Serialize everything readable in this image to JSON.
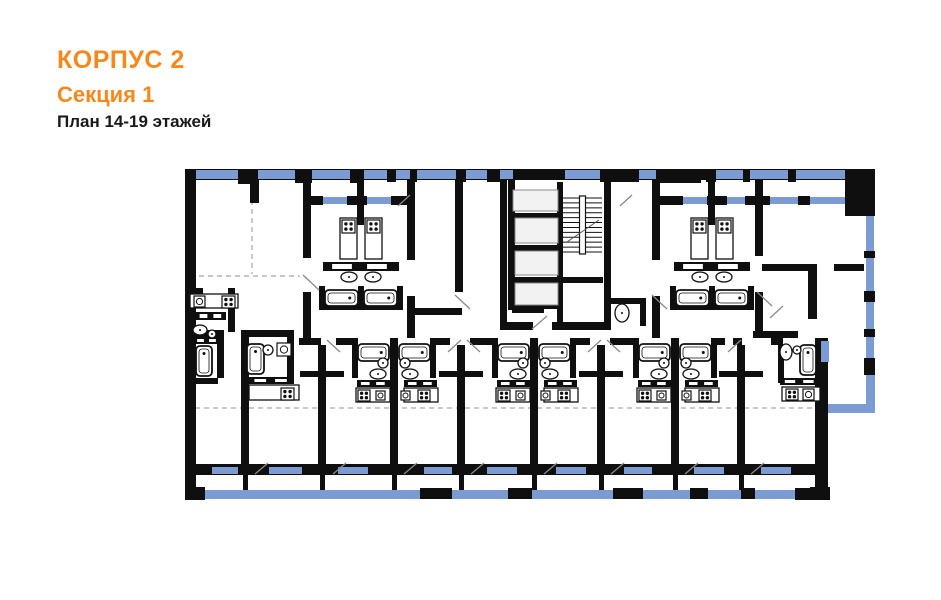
{
  "header": {
    "building": "КОРПУС 2",
    "section": "Секция 1",
    "floors": "План 14-19 этажей"
  },
  "colors": {
    "accent": "#f6891e",
    "text": "#1a1a1a",
    "wall": "#0f0f0f",
    "window": "#7b9bd2",
    "elevator_fill": "#f2f2f2",
    "elevator_stroke": "#8a8a8a",
    "fixture_stroke": "#111111",
    "door": "#8a8a8a",
    "dash": "#b5b5b5"
  },
  "plan": {
    "canvas": {
      "w": 941,
      "h": 600
    },
    "walls": [
      [
        185,
        169,
        690,
        11
      ],
      [
        185,
        169,
        11,
        331
      ],
      [
        185,
        487,
        20,
        13
      ],
      [
        238,
        169,
        20,
        15
      ],
      [
        295,
        169,
        17,
        14
      ],
      [
        350,
        169,
        14,
        14
      ],
      [
        387,
        169,
        9,
        13
      ],
      [
        410,
        169,
        7,
        13
      ],
      [
        456,
        169,
        10,
        13
      ],
      [
        487,
        169,
        13,
        13
      ],
      [
        513,
        169,
        52,
        11
      ],
      [
        600,
        169,
        39,
        13
      ],
      [
        656,
        169,
        45,
        14
      ],
      [
        706,
        169,
        10,
        13
      ],
      [
        743,
        169,
        7,
        13
      ],
      [
        788,
        169,
        8,
        13
      ],
      [
        845,
        169,
        30,
        47
      ],
      [
        864,
        169,
        11,
        47
      ],
      [
        864,
        251,
        11,
        7
      ],
      [
        864,
        291,
        11,
        11
      ],
      [
        864,
        329,
        11,
        8
      ],
      [
        864,
        358,
        11,
        17
      ],
      [
        815,
        338,
        13,
        162
      ],
      [
        810,
        487,
        20,
        13
      ],
      [
        185,
        464,
        643,
        11
      ],
      [
        310,
        196,
        13,
        9
      ],
      [
        347,
        196,
        20,
        9
      ],
      [
        391,
        196,
        20,
        9
      ],
      [
        656,
        196,
        27,
        9
      ],
      [
        707,
        196,
        20,
        9
      ],
      [
        745,
        196,
        14,
        9
      ],
      [
        760,
        196,
        10,
        9
      ],
      [
        798,
        196,
        12,
        9
      ],
      [
        845,
        196,
        14,
        9
      ],
      [
        250,
        180,
        9,
        23
      ],
      [
        303,
        180,
        8,
        78
      ],
      [
        303,
        292,
        8,
        46
      ],
      [
        357,
        180,
        7,
        45
      ],
      [
        407,
        180,
        8,
        80
      ],
      [
        407,
        296,
        8,
        42
      ],
      [
        455,
        180,
        8,
        112
      ],
      [
        500,
        180,
        7,
        150
      ],
      [
        604,
        180,
        7,
        150
      ],
      [
        652,
        180,
        8,
        80
      ],
      [
        652,
        296,
        8,
        42
      ],
      [
        708,
        180,
        7,
        45
      ],
      [
        755,
        180,
        8,
        76
      ],
      [
        755,
        292,
        8,
        46
      ],
      [
        808,
        264,
        9,
        55
      ],
      [
        407,
        308,
        55,
        7
      ],
      [
        762,
        264,
        48,
        7
      ],
      [
        834,
        264,
        30,
        7
      ],
      [
        753,
        331,
        45,
        7
      ],
      [
        319,
        286,
        6,
        24
      ],
      [
        358,
        286,
        6,
        24
      ],
      [
        397,
        286,
        6,
        24
      ],
      [
        321,
        304,
        78,
        6
      ],
      [
        670,
        286,
        6,
        24
      ],
      [
        709,
        286,
        6,
        24
      ],
      [
        748,
        286,
        6,
        24
      ],
      [
        672,
        304,
        80,
        6
      ],
      [
        557,
        182,
        6,
        147
      ],
      [
        508,
        180,
        7,
        130
      ],
      [
        508,
        213,
        52,
        6
      ],
      [
        508,
        245,
        52,
        6
      ],
      [
        508,
        277,
        52,
        6
      ],
      [
        508,
        303,
        52,
        6
      ],
      [
        545,
        283,
        7,
        26
      ],
      [
        512,
        306,
        32,
        7
      ],
      [
        503,
        322,
        30,
        8
      ],
      [
        552,
        322,
        56,
        8
      ],
      [
        563,
        277,
        40,
        6
      ],
      [
        604,
        298,
        42,
        6
      ],
      [
        640,
        304,
        6,
        22
      ],
      [
        228,
        288,
        7,
        44
      ],
      [
        185,
        288,
        18,
        6
      ],
      [
        217,
        330,
        7,
        48
      ],
      [
        185,
        378,
        33,
        6
      ],
      [
        185,
        330,
        35,
        7
      ],
      [
        241,
        330,
        53,
        7
      ],
      [
        287,
        330,
        7,
        50
      ],
      [
        241,
        332,
        8,
        143
      ],
      [
        318,
        345,
        8,
        130
      ],
      [
        300,
        371,
        44,
        6
      ],
      [
        457,
        345,
        8,
        130
      ],
      [
        439,
        371,
        44,
        6
      ],
      [
        597,
        345,
        8,
        130
      ],
      [
        579,
        371,
        44,
        6
      ],
      [
        737,
        345,
        8,
        130
      ],
      [
        719,
        371,
        44,
        6
      ],
      [
        352,
        338,
        6,
        40
      ],
      [
        430,
        338,
        6,
        40
      ],
      [
        390,
        338,
        8,
        137
      ],
      [
        492,
        338,
        6,
        40
      ],
      [
        570,
        338,
        6,
        40
      ],
      [
        530,
        338,
        8,
        137
      ],
      [
        633,
        338,
        6,
        40
      ],
      [
        711,
        338,
        6,
        40
      ],
      [
        671,
        338,
        8,
        137
      ],
      [
        299,
        338,
        22,
        7
      ],
      [
        336,
        338,
        18,
        7
      ],
      [
        434,
        338,
        16,
        7
      ],
      [
        470,
        338,
        24,
        7
      ],
      [
        574,
        338,
        16,
        7
      ],
      [
        610,
        338,
        25,
        7
      ],
      [
        715,
        338,
        10,
        7
      ],
      [
        733,
        338,
        9,
        7
      ],
      [
        771,
        338,
        12,
        7
      ],
      [
        778,
        345,
        6,
        38
      ],
      [
        243,
        475,
        5,
        15
      ],
      [
        320,
        475,
        5,
        15
      ],
      [
        392,
        475,
        5,
        15
      ],
      [
        459,
        475,
        5,
        15
      ],
      [
        532,
        475,
        5,
        15
      ],
      [
        599,
        475,
        5,
        15
      ],
      [
        673,
        475,
        5,
        15
      ],
      [
        739,
        475,
        5,
        15
      ]
    ],
    "windows": [
      [
        196,
        170,
        42,
        9
      ],
      [
        258,
        170,
        37,
        9
      ],
      [
        312,
        170,
        38,
        9
      ],
      [
        364,
        170,
        23,
        9
      ],
      [
        396,
        170,
        14,
        9
      ],
      [
        417,
        170,
        39,
        9
      ],
      [
        466,
        170,
        21,
        9
      ],
      [
        500,
        170,
        13,
        9
      ],
      [
        565,
        170,
        35,
        9
      ],
      [
        639,
        170,
        17,
        9
      ],
      [
        716,
        170,
        27,
        9
      ],
      [
        750,
        170,
        38,
        9
      ],
      [
        796,
        170,
        49,
        9
      ],
      [
        323,
        197,
        24,
        7
      ],
      [
        367,
        197,
        24,
        7
      ],
      [
        683,
        197,
        24,
        7
      ],
      [
        727,
        197,
        18,
        7
      ],
      [
        770,
        197,
        28,
        7
      ],
      [
        810,
        197,
        35,
        7
      ],
      [
        866,
        216,
        8,
        35
      ],
      [
        866,
        258,
        8,
        33
      ],
      [
        866,
        302,
        8,
        27
      ],
      [
        866,
        337,
        8,
        21
      ],
      [
        821,
        341,
        8,
        21
      ],
      [
        212,
        467,
        26,
        7
      ],
      [
        269,
        467,
        33,
        7
      ],
      [
        338,
        467,
        30,
        7
      ],
      [
        424,
        467,
        28,
        7
      ],
      [
        487,
        467,
        30,
        7
      ],
      [
        556,
        467,
        30,
        7
      ],
      [
        624,
        467,
        28,
        7
      ],
      [
        694,
        467,
        30,
        7
      ],
      [
        761,
        467,
        30,
        7
      ]
    ],
    "balcony": {
      "strips": [
        [
          203,
          490,
          625,
          9
        ],
        [
          866,
          375,
          9,
          31
        ],
        [
          827,
          404,
          48,
          9
        ]
      ],
      "posts": [
        [
          420,
          488,
          32,
          11
        ],
        [
          508,
          488,
          24,
          11
        ],
        [
          613,
          488,
          30,
          11
        ],
        [
          690,
          488,
          18,
          11
        ],
        [
          741,
          488,
          14,
          11
        ],
        [
          795,
          488,
          22,
          12
        ]
      ]
    },
    "dashed_lines": [
      [
        195,
        408,
        864,
        408
      ],
      [
        190,
        276,
        300,
        276
      ],
      [
        252,
        200,
        252,
        274
      ]
    ],
    "door_swings": [
      [
        303,
        275,
        319,
        290
      ],
      [
        455,
        295,
        470,
        309
      ],
      [
        652,
        295,
        667,
        309
      ],
      [
        757,
        292,
        772,
        306
      ],
      [
        340,
        352,
        327,
        340
      ],
      [
        448,
        352,
        461,
        340
      ],
      [
        480,
        352,
        467,
        340
      ],
      [
        588,
        352,
        601,
        340
      ],
      [
        620,
        352,
        607,
        340
      ],
      [
        728,
        352,
        741,
        340
      ],
      [
        255,
        474,
        268,
        463
      ],
      [
        333,
        474,
        346,
        463
      ],
      [
        404,
        474,
        417,
        463
      ],
      [
        471,
        474,
        484,
        463
      ],
      [
        544,
        474,
        557,
        463
      ],
      [
        611,
        474,
        624,
        463
      ],
      [
        685,
        474,
        698,
        463
      ],
      [
        751,
        474,
        764,
        463
      ],
      [
        532,
        329,
        547,
        316
      ],
      [
        770,
        318,
        783,
        306
      ],
      [
        398,
        206,
        410,
        195
      ],
      [
        620,
        206,
        632,
        195
      ]
    ],
    "elevators": [
      [
        515,
        218,
        43,
        25
      ],
      [
        515,
        251,
        43,
        24
      ],
      [
        515,
        283,
        43,
        22
      ],
      [
        513,
        190,
        45,
        21
      ]
    ],
    "stairs": {
      "x": 563,
      "y": 198,
      "w": 39,
      "h": 54,
      "steps": 11
    },
    "fixtures": {
      "tubs": [
        [
          325,
          290,
          33,
          16
        ],
        [
          364,
          290,
          33,
          16
        ],
        [
          676,
          290,
          33,
          16
        ],
        [
          715,
          290,
          33,
          16
        ],
        [
          358,
          344,
          31,
          17
        ],
        [
          399,
          344,
          31,
          17
        ],
        [
          498,
          344,
          31,
          17
        ],
        [
          539,
          344,
          31,
          17
        ],
        [
          639,
          344,
          31,
          17
        ],
        [
          680,
          344,
          31,
          17
        ],
        [
          196,
          346,
          16,
          30
        ],
        [
          247,
          344,
          17,
          30
        ],
        [
          800,
          345,
          16,
          30
        ]
      ],
      "stoves": [
        [
          342,
          220,
          13,
          13
        ],
        [
          367,
          220,
          13,
          13
        ],
        [
          693,
          220,
          13,
          13
        ],
        [
          718,
          220,
          13,
          13
        ],
        [
          358,
          390,
          12,
          11
        ],
        [
          418,
          390,
          12,
          11
        ],
        [
          498,
          390,
          12,
          11
        ],
        [
          558,
          390,
          12,
          11
        ],
        [
          639,
          390,
          12,
          11
        ],
        [
          699,
          390,
          12,
          11
        ],
        [
          222,
          296,
          13,
          12
        ],
        [
          281,
          388,
          13,
          12
        ],
        [
          786,
          389,
          12,
          11
        ]
      ],
      "counters": [
        [
          340,
          218,
          17,
          41
        ],
        [
          365,
          218,
          17,
          41
        ],
        [
          691,
          218,
          17,
          41
        ],
        [
          716,
          218,
          17,
          41
        ],
        [
          356,
          388,
          34,
          14
        ],
        [
          404,
          388,
          34,
          14
        ],
        [
          496,
          388,
          34,
          14
        ],
        [
          544,
          388,
          34,
          14
        ],
        [
          637,
          388,
          34,
          14
        ],
        [
          685,
          388,
          34,
          14
        ],
        [
          190,
          294,
          48,
          14
        ],
        [
          249,
          385,
          50,
          15
        ],
        [
          782,
          387,
          38,
          14
        ]
      ],
      "bars": [
        [
          323,
          262,
          76,
          9
        ],
        [
          674,
          262,
          76,
          9
        ],
        [
          357,
          380,
          33,
          7
        ],
        [
          404,
          380,
          33,
          7
        ],
        [
          497,
          380,
          33,
          7
        ],
        [
          544,
          380,
          33,
          7
        ],
        [
          638,
          380,
          33,
          7
        ],
        [
          685,
          380,
          33,
          7
        ],
        [
          196,
          312,
          30,
          8
        ],
        [
          194,
          337,
          26,
          7
        ],
        [
          249,
          377,
          45,
          7
        ],
        [
          780,
          378,
          40,
          7
        ]
      ],
      "sink_ovals": [
        [
          349,
          277,
          8,
          5
        ],
        [
          373,
          277,
          8,
          5
        ],
        [
          700,
          277,
          8,
          5
        ],
        [
          724,
          277,
          8,
          5
        ],
        [
          378,
          374,
          8,
          5
        ],
        [
          410,
          374,
          8,
          5
        ],
        [
          518,
          374,
          8,
          5
        ],
        [
          550,
          374,
          8,
          5
        ],
        [
          659,
          374,
          8,
          5
        ],
        [
          691,
          374,
          8,
          5
        ],
        [
          200,
          330,
          7,
          5
        ],
        [
          786,
          352,
          6,
          8
        ],
        [
          622,
          313,
          7,
          9
        ]
      ],
      "sink_squares": [
        [
          194,
          296,
          11,
          11
        ],
        [
          277,
          343,
          14,
          13
        ],
        [
          376,
          391,
          9,
          9
        ],
        [
          401,
          391,
          9,
          9
        ],
        [
          516,
          391,
          9,
          9
        ],
        [
          541,
          391,
          9,
          9
        ],
        [
          657,
          391,
          9,
          9
        ],
        [
          682,
          391,
          9,
          9
        ],
        [
          803,
          389,
          11,
          11
        ]
      ],
      "wcs": [
        [
          383,
          363,
          5
        ],
        [
          405,
          363,
          5
        ],
        [
          523,
          363,
          5
        ],
        [
          545,
          363,
          5
        ],
        [
          664,
          363,
          5
        ],
        [
          686,
          363,
          5
        ],
        [
          212,
          334,
          4
        ],
        [
          268,
          350,
          5
        ],
        [
          797,
          350,
          4
        ]
      ]
    }
  }
}
